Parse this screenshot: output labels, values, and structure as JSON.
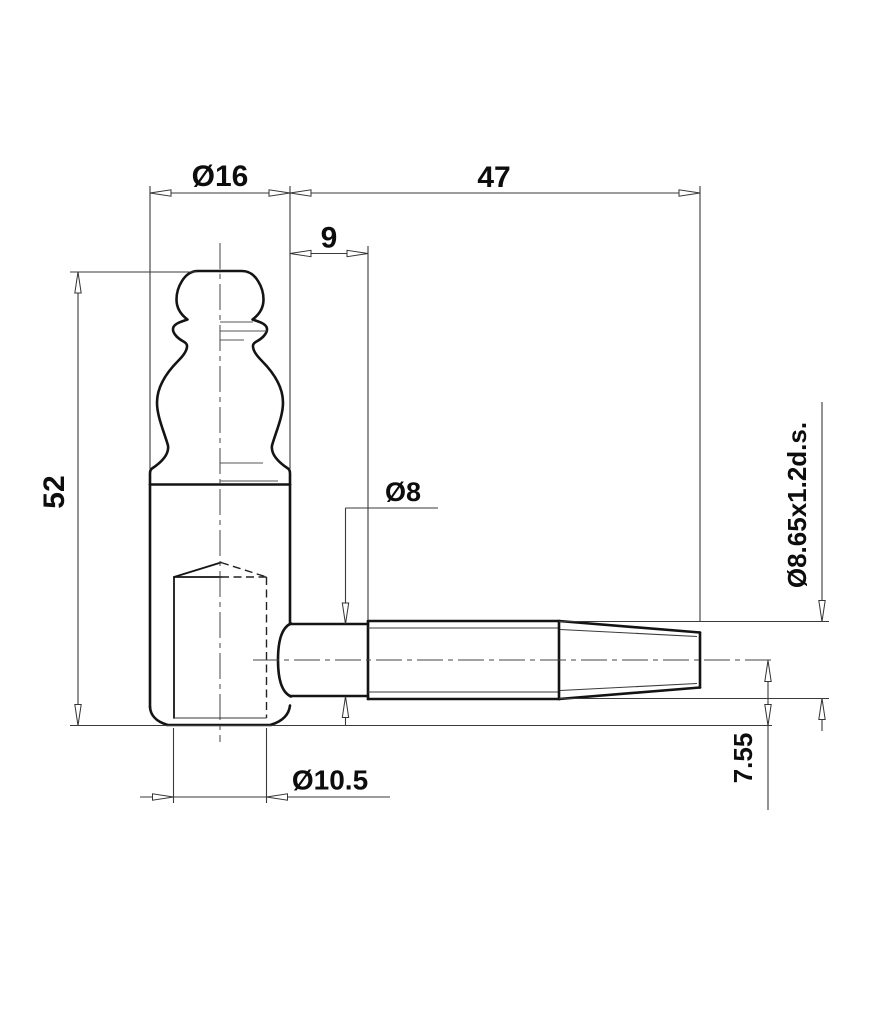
{
  "drawing": {
    "labels": {
      "head_diameter": "Ø16",
      "screw_length": "47",
      "shank_length": "9",
      "body_height": "52",
      "shank_diameter": "Ø8",
      "thread_spec": "Ø8.65x1.2d.s.",
      "hole_diameter": "Ø10.5",
      "axis_offset": "7.55"
    },
    "colors": {
      "background": "#ffffff",
      "line_color": "#141414"
    }
  }
}
